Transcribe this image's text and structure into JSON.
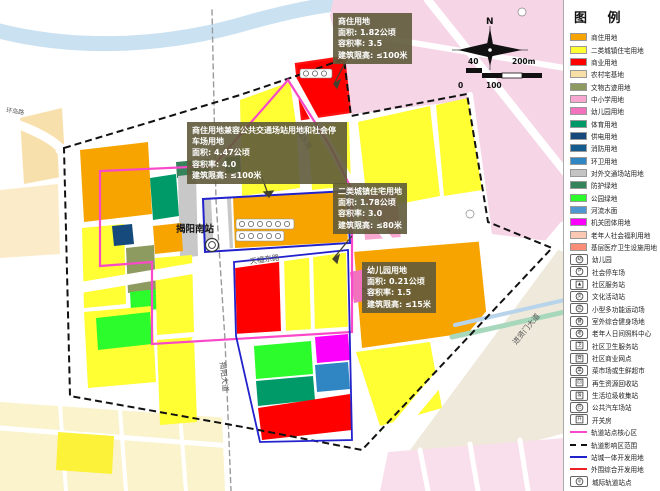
{
  "map": {
    "station_name": "揭阳南站",
    "roads": {
      "huandaolu": "环岛路",
      "meidonglu": "梅东路",
      "tianfudonglu": "天福东路",
      "jieyangdadao": "揭阳大道",
      "jinxianmendadao": "进贤门大道"
    },
    "compass_north": "N",
    "scale": {
      "t40": "40",
      "t200": "200m",
      "t0": "0",
      "t100": "100"
    }
  },
  "callouts": {
    "top": {
      "title": "商住用地",
      "area": "面积: 1.82公顷",
      "far": "容积率: 3.5",
      "height": "建筑限高: ≤100米"
    },
    "left": {
      "title": "商住用地兼容公共交通场站用地和社会停车场用地",
      "area": "面积: 4.47公顷",
      "far": "容积率: 4.0",
      "height": "建筑限高: ≤100米"
    },
    "mid": {
      "title": "二类城镇住宅用地",
      "area": "面积: 1.78公顷",
      "far": "容积率: 3.0",
      "height": "建筑限高: ≤80米"
    },
    "bottom": {
      "title": "幼儿园用地",
      "area": "面积: 0.21公顷",
      "far": "容积率: 1.5",
      "height": "建筑限高: ≤15米"
    }
  },
  "legend": {
    "title": "图 例",
    "items": [
      {
        "type": "swatch",
        "color": "#F7A400",
        "label": "商住用地"
      },
      {
        "type": "swatch",
        "color": "#FFFF33",
        "label": "二类城镇住宅用地"
      },
      {
        "type": "swatch",
        "color": "#FE0000",
        "label": "商业用地"
      },
      {
        "type": "swatch",
        "color": "#F8DFA8",
        "label": "农村宅基地"
      },
      {
        "type": "swatch",
        "color": "#8E9B60",
        "label": "文物古迹用地"
      },
      {
        "type": "swatch",
        "color": "#F8A8D0",
        "label": "中小学用地"
      },
      {
        "type": "swatch",
        "color": "#F272BE",
        "label": "幼儿园用地"
      },
      {
        "type": "swatch",
        "color": "#009A68",
        "label": "体育用地"
      },
      {
        "type": "swatch",
        "color": "#164A7C",
        "label": "供电用地"
      },
      {
        "type": "swatch",
        "color": "#135C8D",
        "label": "消防用地"
      },
      {
        "type": "swatch",
        "color": "#2F86C2",
        "label": "环卫用地"
      },
      {
        "type": "swatch",
        "color": "#C4C4C4",
        "label": "对外交通场站用地"
      },
      {
        "type": "swatch",
        "color": "#35835A",
        "label": "防护绿地"
      },
      {
        "type": "swatch",
        "color": "#2CFC2C",
        "label": "公园绿地"
      },
      {
        "type": "swatch",
        "color": "#4E97D1",
        "label": "河流水面"
      },
      {
        "type": "swatch",
        "color": "#FB00FB",
        "label": "机关团体用地"
      },
      {
        "type": "swatch",
        "color": "#FBC8B4",
        "label": "老年人社会福利用地"
      },
      {
        "type": "swatch",
        "color": "#F98D78",
        "label": "基层医疗卫生设施用地"
      },
      {
        "type": "icon",
        "shape": "circle",
        "glyph": "幼",
        "label": "幼儿园"
      },
      {
        "type": "icon",
        "shape": "circle",
        "glyph": "P",
        "label": "社会停车场"
      },
      {
        "type": "icon",
        "shape": "box",
        "glyph": "▲",
        "label": "社区服务站"
      },
      {
        "type": "icon",
        "shape": "circle",
        "glyph": "文",
        "label": "文化活动站"
      },
      {
        "type": "icon",
        "shape": "circle",
        "glyph": "运",
        "label": "小型多功能运动场"
      },
      {
        "type": "icon",
        "shape": "circle",
        "glyph": "健",
        "label": "室外综合健身场地"
      },
      {
        "type": "icon",
        "shape": "circle",
        "glyph": "老",
        "label": "老年人日间照料中心"
      },
      {
        "type": "icon",
        "shape": "box",
        "glyph": "卫",
        "label": "社区卫生服务站"
      },
      {
        "type": "icon",
        "shape": "box",
        "glyph": "商",
        "label": "社区商业网点"
      },
      {
        "type": "icon",
        "shape": "circle",
        "glyph": "菜",
        "label": "菜市场或生鲜超市"
      },
      {
        "type": "icon",
        "shape": "box",
        "glyph": "回",
        "label": "再生资源回收站"
      },
      {
        "type": "icon",
        "shape": "box",
        "glyph": "圾",
        "label": "生活垃圾收集站"
      },
      {
        "type": "icon",
        "shape": "circle",
        "glyph": "巴",
        "label": "公共汽车场站"
      },
      {
        "type": "icon",
        "shape": "box",
        "glyph": "开",
        "label": "开关房"
      },
      {
        "type": "line",
        "color": "#F948C8",
        "dashed": false,
        "label": "轨道站点核心区"
      },
      {
        "type": "line",
        "color": "#111111",
        "dashed": true,
        "label": "轨道影响区范围"
      },
      {
        "type": "line",
        "color": "#2222CC",
        "dashed": false,
        "label": "站城一体开发用地"
      },
      {
        "type": "line",
        "color": "#EE2222",
        "dashed": false,
        "label": "外围综合开发用地"
      },
      {
        "type": "icon",
        "shape": "circle",
        "glyph": "◎",
        "label": "城际轨道站点"
      }
    ]
  },
  "colors": {
    "core_area_line": "#F948C8",
    "influence_line": "#111111",
    "station_city_line": "#2222CC",
    "outer_dev_line": "#EE2222"
  }
}
